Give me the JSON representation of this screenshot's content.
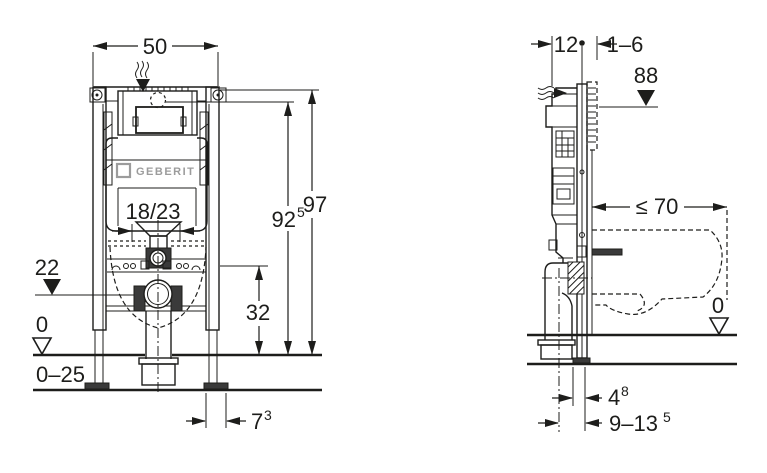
{
  "drawing": {
    "type": "installation-diagram",
    "product": "concealed cistern mounting frame",
    "line_color": "#1d1d1b",
    "logo_color": "#9c9c9c"
  },
  "front": {
    "width": "50",
    "logo": "GEBERIT",
    "bolt_spacing": "18/23",
    "outlet_height": "22",
    "zero": "0",
    "floor_range": "0–25",
    "drain_height": "32",
    "h_sub": "92",
    "h_sub_sup": "5",
    "h": "97",
    "foot": "7",
    "foot_sup": "3"
  },
  "side": {
    "depth": "12",
    "wall": "1–6",
    "act": "88",
    "max": "≤ 70",
    "zero": "0",
    "a": "4",
    "a_sup": "8",
    "b": "9–13",
    "b_sup": "5"
  }
}
